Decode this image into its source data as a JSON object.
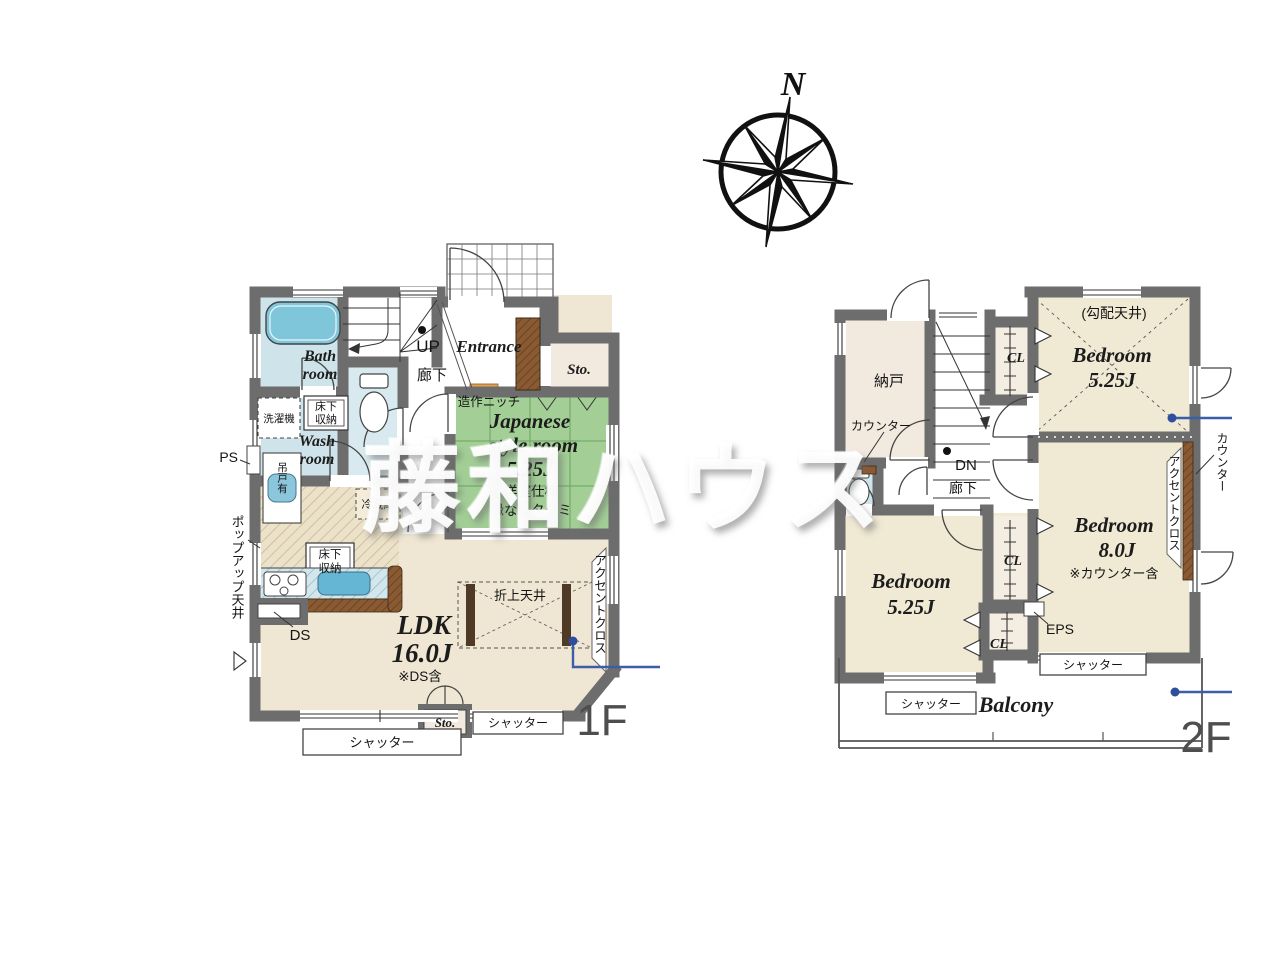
{
  "watermark": {
    "text": "藤和ハウス"
  },
  "compass": {
    "north": "N"
  },
  "colors": {
    "wall": "#6d6d6d",
    "tatami_green": "#a3cf97",
    "water_blue": "#cfe4ea",
    "tub_blue": "#7fc6db",
    "floor_beige": "#efe7d3",
    "storage_beige": "#f2e9df",
    "wood_brown": "#8a5a33",
    "counter_hatch_blue": "#d3e6ec",
    "callout_blue": "#3a5fa8",
    "niche_orange": "#e3a24f"
  },
  "f1": {
    "label": "1F",
    "up": "UP",
    "hallway": "廊下",
    "entrance": "Entrance",
    "storage_upper": "Sto.",
    "niche": "造作ニッチ",
    "jp1": "Japanese",
    "jp2": "-style room",
    "jp3": "5.25J",
    "jp_note1": "洋室仕様",
    "jp_note2": "縁なしタタミ",
    "bath1": "Bath",
    "bath2": "room",
    "washer": "洗濯機",
    "uf1a": "床下",
    "uf1b": "収納",
    "wash1": "Wash",
    "wash2": "room",
    "hanging": "吊戸有",
    "ps": "PS",
    "fridge": "冷蔵庫",
    "kuf1": "床下",
    "kuf2": "収納",
    "popup": "ポップアップ天井",
    "ds": "DS",
    "ldk1": "LDK",
    "ldk2": "16.0J",
    "ldk_note": "※DS含",
    "raised_ceiling": "折上天井",
    "accent": "アクセントクロス",
    "storage_lower": "Sto.",
    "shutter_left": "シャッター",
    "shutter_right": "シャッター"
  },
  "f2": {
    "label": "2F",
    "storeroom": "納戸",
    "counter_left": "カウンター",
    "cl_top": "CL",
    "dn": "DN",
    "hallway": "廊下",
    "sloped_ceiling": "(勾配天井)",
    "b1a": "Bedroom",
    "b1b": "5.25J",
    "counter_right": "カウンター",
    "accent": "アクセントクロス",
    "b2a": "Bedroom",
    "b2b": "8.0J",
    "b2_note": "※カウンター含",
    "b3a": "Bedroom",
    "b3b": "5.25J",
    "cl_mid": "CL",
    "cl_low": "CL",
    "eps": "EPS",
    "shutter_left": "シャッター",
    "shutter_right": "シャッター",
    "balcony": "Balcony"
  }
}
